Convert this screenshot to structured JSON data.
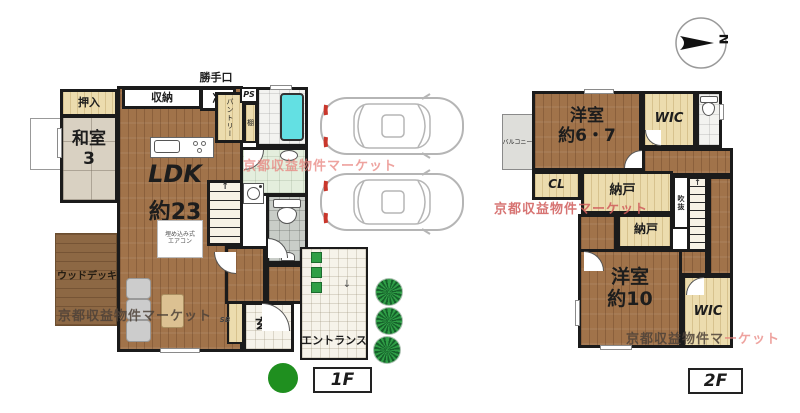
{
  "watermark_text": "京都収益物件マーケット",
  "compass": {
    "north_label": "N"
  },
  "floor1": {
    "floor_label": "1F",
    "katteguchi": "勝手口",
    "oshiire": "押入",
    "washitsu_name": "和室",
    "washitsu_size": "3",
    "shuno": "収納",
    "rei": "冷",
    "ps": "PS",
    "pantry": "パントリー",
    "tana": "棚",
    "ldk_name": "LDK",
    "ldk_size": "約23",
    "aircon_line1": "埋め込み式",
    "aircon_line2": "エアコン",
    "wood_deck": "ウッドデッキ",
    "genkan": "玄関",
    "entrance": "エントランス",
    "shoe_note": "SB",
    "stair_arrow": "↑",
    "approach_arrow": "↓"
  },
  "floor2": {
    "floor_label": "2F",
    "yoshitsu_a_name": "洋室",
    "yoshitsu_a_size": "約6・7",
    "wic_top": "WIC",
    "balcony": "バルコニー",
    "cl": "CL",
    "nando_a": "納戸",
    "nando_b": "納戸",
    "fukinuke": "吹抜",
    "yoshitsu_b_name": "洋室",
    "yoshitsu_b_size": "約10",
    "wic_bottom": "WIC",
    "stair_arrow": "↑"
  },
  "watermarks": {
    "wm1": "京都収益物件マーケット",
    "wm2": "京都収益物件マーケット",
    "wm3": "京都収益物件マーケット",
    "wm4_dark": "京都収益物件マ",
    "wm4_pink": "ーケット"
  },
  "colors": {
    "wall": "#1b1b1b",
    "wood_floor": "#a1734a",
    "closet": "#ecdcae",
    "tatami": "#d9d1c2",
    "bathtub": "#63e0e3",
    "watermark_pink": "#e8807a",
    "green_dot": "#1f8f1f"
  }
}
